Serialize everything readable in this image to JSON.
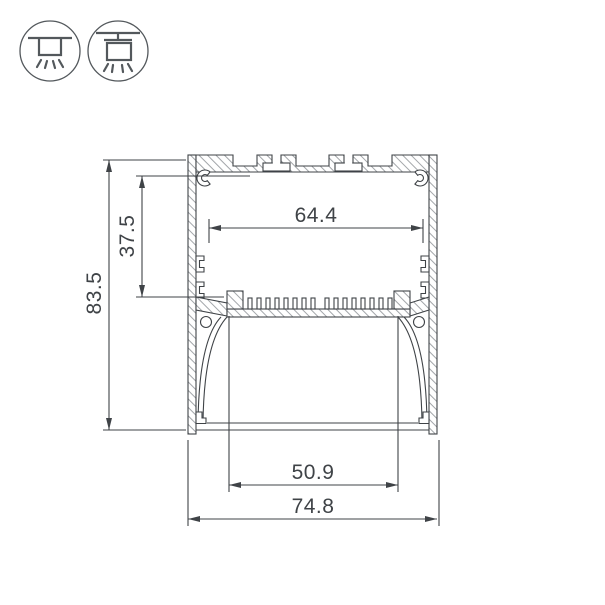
{
  "page": {
    "background": "#ffffff"
  },
  "mount_icons": {
    "items": [
      {
        "name": "surface-mount-icon"
      },
      {
        "name": "suspended-mount-icon"
      }
    ]
  },
  "drawing": {
    "type": "technical-cross-section",
    "dimension_labels": {
      "overall_height": "83.5",
      "cavity_height": "37.5",
      "top_cavity_width": "64.4",
      "diffuser_width": "50.9",
      "overall_width": "74.8"
    },
    "colors": {
      "line": "#3f4347",
      "hatch": "#8b9094",
      "dimension": "#3f4347",
      "icon": "#53585c",
      "background": "#ffffff"
    }
  }
}
